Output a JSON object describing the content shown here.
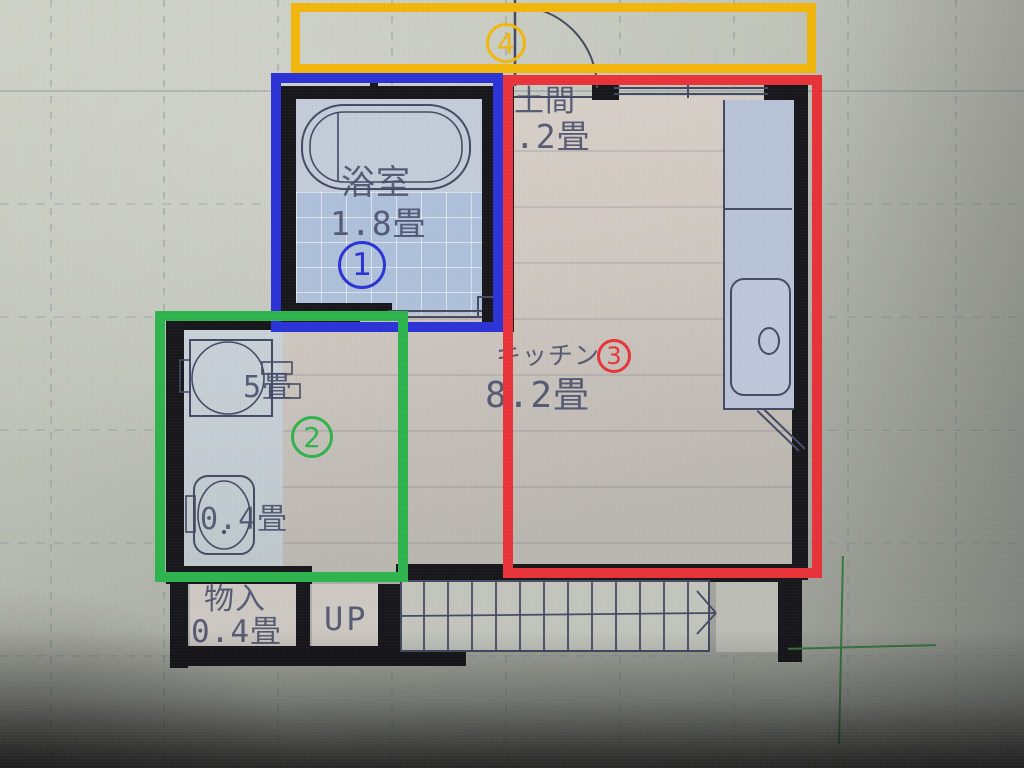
{
  "colors": {
    "annotation_blue": "#2b32d6",
    "annotation_red": "#e93338",
    "annotation_green": "#2db44d",
    "annotation_orange": "#f2b70a",
    "plan_line": "#454a63",
    "wall": "#17171b",
    "tile_floor": "#aec0da",
    "main_floor": "#d2cbc4"
  },
  "annotations": {
    "box1": {
      "number": "1"
    },
    "box2": {
      "number": "2"
    },
    "box3": {
      "number": "3"
    },
    "box4": {
      "number": "4"
    }
  },
  "rooms": {
    "bathroom": {
      "name": "浴室",
      "area": "1.8畳"
    },
    "doma": {
      "name": "土間",
      "area": "1.2畳"
    },
    "kitchen": {
      "name": "キッチン",
      "area": "8.2畳"
    },
    "washbasin": {
      "area": "5畳"
    },
    "toilet": {
      "area": "0.4畳"
    },
    "storage": {
      "name": "物入",
      "area": "0.4畳"
    },
    "stairs": {
      "label": "UP"
    }
  }
}
